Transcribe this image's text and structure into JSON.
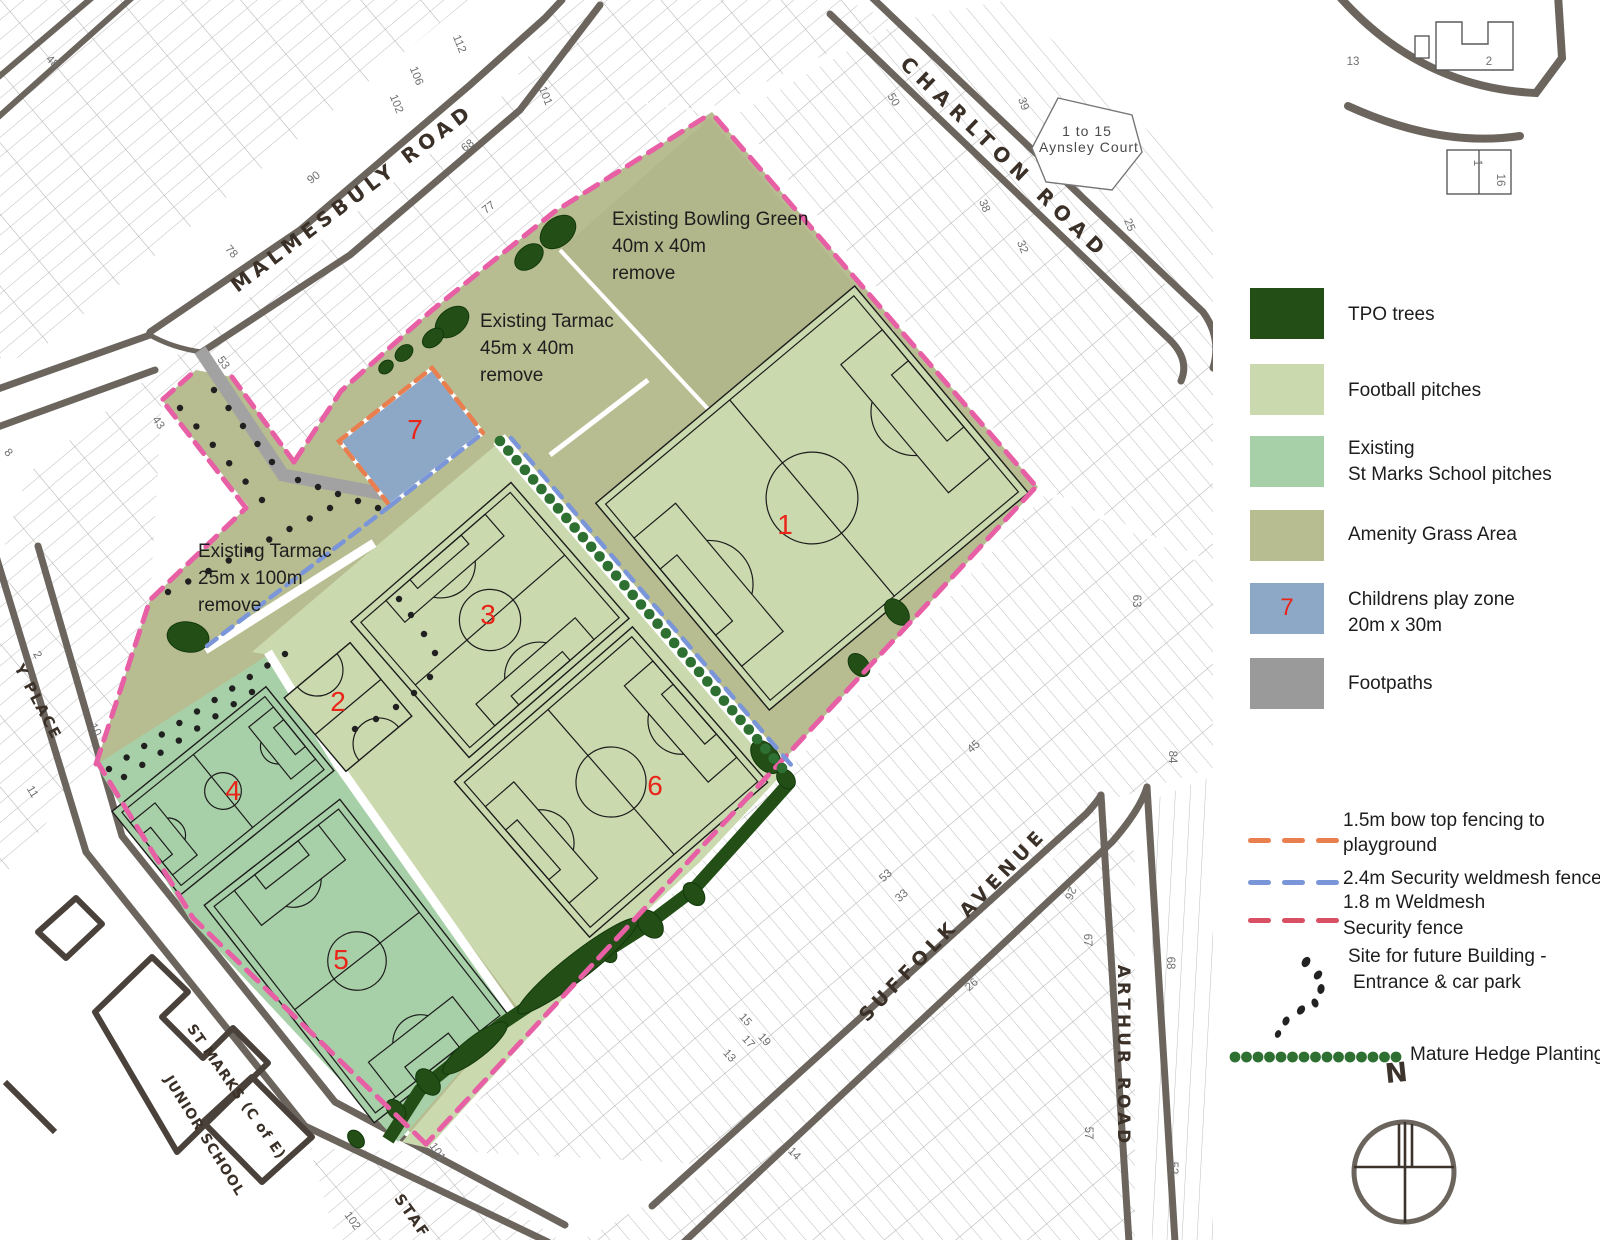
{
  "colors": {
    "olive": "#b7bd90",
    "bowling": "#b0b689",
    "pitch_light": "#cbd9ae",
    "pitch_school": "#a8d0a8",
    "play_blue": "#8ca8c6",
    "tpo": "#234f16",
    "hedge": "#2e7031",
    "path_gray": "#a2a2a2",
    "fence_pink": "#e75fa4",
    "fence_red": "#d94f63",
    "fence_orange": "#e97e4f",
    "fence_blue": "#7b96d8",
    "number_red": "#e92519",
    "road": "#6b655e"
  },
  "legend": {
    "items": [
      {
        "name": "tpo-trees",
        "label": "TPO trees",
        "color": "#234f16"
      },
      {
        "name": "football-pitches",
        "label": "Football pitches",
        "color": "#cbd9ae"
      },
      {
        "name": "st-marks-pitches",
        "label": "Existing",
        "label2": "St Marks School pitches",
        "color": "#a8d0a8"
      },
      {
        "name": "amenity-grass",
        "label": "Amenity Grass Area",
        "color": "#b7bd90"
      },
      {
        "name": "childrens-play-zone",
        "label": "Childrens play zone",
        "label2": "20m x 30m",
        "color": "#8ca8c6",
        "number": "7"
      },
      {
        "name": "footpaths",
        "label": "Footpaths",
        "color": "#9a9a9a"
      }
    ],
    "fences": [
      {
        "name": "bow-top-fence",
        "line1": "1.5m bow top fencing to",
        "line2": "playground",
        "color": "#e97e4f"
      },
      {
        "name": "security-weldmesh-24",
        "line1": "2.4m  Security  weldmesh fence",
        "line2": "",
        "color": "#7b96d8"
      },
      {
        "name": "weldmesh-18",
        "line1": "1.8 m  Weldmesh",
        "line2": "Security fence",
        "color": "#d94f63"
      }
    ],
    "future_building": {
      "line1": "Site for future Building -",
      "line2": "Entrance & car park"
    },
    "hedge_label": "Mature Hedge Planting",
    "compass_n": "N"
  },
  "annotations": [
    {
      "lines": [
        "Existing Bowling Green",
        "40m x 40m",
        "remove"
      ],
      "x": 612,
      "y": 206
    },
    {
      "lines": [
        "Existing  Tarmac",
        "45m x 40m",
        "remove"
      ],
      "x": 480,
      "y": 308
    },
    {
      "lines": [
        "Existing  Tarmac",
        "25m x 100m",
        "remove"
      ],
      "x": 198,
      "y": 538
    }
  ],
  "pitch_numbers": [
    {
      "n": "1",
      "x": 785,
      "y": 525
    },
    {
      "n": "2",
      "x": 338,
      "y": 702
    },
    {
      "n": "3",
      "x": 488,
      "y": 615
    },
    {
      "n": "4",
      "x": 233,
      "y": 791
    },
    {
      "n": "5",
      "x": 341,
      "y": 960
    },
    {
      "n": "6",
      "x": 655,
      "y": 786
    },
    {
      "n": "7",
      "x": 415,
      "y": 430
    }
  ],
  "streets": [
    {
      "id": "malmesbury-road",
      "label": "MALMESBULY ROAD",
      "x": 352,
      "y": 198,
      "rot": -37,
      "size": 20,
      "ls": 5
    },
    {
      "id": "charlton-road",
      "label": "CHARLTON ROAD",
      "x": 1005,
      "y": 158,
      "rot": 44,
      "size": 20,
      "ls": 7
    },
    {
      "id": "suffolk-avenue",
      "label": "SUFFOLK AVENUE",
      "x": 953,
      "y": 925,
      "rot": -46,
      "size": 19,
      "ls": 5
    },
    {
      "id": "arthur-road",
      "label": "ARTHUR ROAD",
      "x": 1123,
      "y": 1056,
      "rot": 90,
      "size": 17,
      "ls": 4
    },
    {
      "id": "y-place",
      "label": "Y PLACE",
      "x": 38,
      "y": 702,
      "rot": 62,
      "size": 15,
      "ls": 2
    },
    {
      "id": "stanley-road",
      "label": "STAF",
      "x": 412,
      "y": 1216,
      "rot": 55,
      "size": 15,
      "ls": 2
    },
    {
      "id": "st-marks-school-1",
      "label": "ST MARKS (C of E)",
      "x": 236,
      "y": 1092,
      "rot": 55,
      "size": 14,
      "ls": 1
    },
    {
      "id": "st-marks-school-2",
      "label": "JUNIOR SCHOOL",
      "x": 204,
      "y": 1136,
      "rot": 58,
      "size": 14,
      "ls": 1
    }
  ],
  "places": [
    {
      "label": "1 to 15",
      "x": 1087,
      "y": 131
    },
    {
      "label": "Aynsley Court",
      "x": 1089,
      "y": 147
    }
  ],
  "house_numbers": [
    {
      "t": "48",
      "x": 52,
      "y": 62,
      "r": 45
    },
    {
      "t": "90",
      "x": 314,
      "y": 178,
      "r": -38
    },
    {
      "t": "102",
      "x": 396,
      "y": 104,
      "r": 68
    },
    {
      "t": "106",
      "x": 416,
      "y": 76,
      "r": 68
    },
    {
      "t": "112",
      "x": 459,
      "y": 44,
      "r": 68
    },
    {
      "t": "101",
      "x": 545,
      "y": 96,
      "r": 68
    },
    {
      "t": "78",
      "x": 231,
      "y": 252,
      "r": 48
    },
    {
      "t": "68",
      "x": 468,
      "y": 146,
      "r": -38
    },
    {
      "t": "77",
      "x": 489,
      "y": 208,
      "r": -38
    },
    {
      "t": "53",
      "x": 223,
      "y": 363,
      "r": 55
    },
    {
      "t": "43",
      "x": 158,
      "y": 423,
      "r": 55
    },
    {
      "t": "8",
      "x": 8,
      "y": 453,
      "r": 48
    },
    {
      "t": "2",
      "x": 37,
      "y": 655,
      "r": 60
    },
    {
      "t": "10",
      "x": 95,
      "y": 730,
      "r": 60
    },
    {
      "t": "11",
      "x": 32,
      "y": 792,
      "r": 60
    },
    {
      "t": "50",
      "x": 893,
      "y": 100,
      "r": 58
    },
    {
      "t": "39",
      "x": 1023,
      "y": 104,
      "r": 70
    },
    {
      "t": "38",
      "x": 984,
      "y": 206,
      "r": 68
    },
    {
      "t": "32",
      "x": 1022,
      "y": 247,
      "r": 68
    },
    {
      "t": "25",
      "x": 1129,
      "y": 225,
      "r": 68
    },
    {
      "t": "13",
      "x": 1353,
      "y": 62,
      "r": 0
    },
    {
      "t": "2",
      "x": 1489,
      "y": 62,
      "r": 0
    },
    {
      "t": "1",
      "x": 1477,
      "y": 163,
      "r": 90
    },
    {
      "t": "16",
      "x": 1500,
      "y": 180,
      "r": 90
    },
    {
      "t": "63",
      "x": 1136,
      "y": 601,
      "r": 90
    },
    {
      "t": "84",
      "x": 1172,
      "y": 757,
      "r": 90
    },
    {
      "t": "45",
      "x": 974,
      "y": 747,
      "r": -42
    },
    {
      "t": "53",
      "x": 886,
      "y": 876,
      "r": -42
    },
    {
      "t": "33",
      "x": 902,
      "y": 896,
      "r": -42
    },
    {
      "t": "26",
      "x": 972,
      "y": 985,
      "r": -42
    },
    {
      "t": "67",
      "x": 1087,
      "y": 940,
      "r": 90
    },
    {
      "t": "26",
      "x": 1070,
      "y": 893,
      "r": 115
    },
    {
      "t": "57",
      "x": 1088,
      "y": 1133,
      "r": 90
    },
    {
      "t": "68",
      "x": 1170,
      "y": 963,
      "r": 90
    },
    {
      "t": "52",
      "x": 1173,
      "y": 1168,
      "r": 90
    },
    {
      "t": "15",
      "x": 745,
      "y": 1020,
      "r": 48
    },
    {
      "t": "17",
      "x": 748,
      "y": 1042,
      "r": 48
    },
    {
      "t": "13",
      "x": 729,
      "y": 1056,
      "r": 48
    },
    {
      "t": "19",
      "x": 764,
      "y": 1040,
      "r": 48
    },
    {
      "t": "101",
      "x": 437,
      "y": 1152,
      "r": 55
    },
    {
      "t": "102",
      "x": 352,
      "y": 1221,
      "r": 55
    },
    {
      "t": "14",
      "x": 794,
      "y": 1154,
      "r": 45
    }
  ]
}
